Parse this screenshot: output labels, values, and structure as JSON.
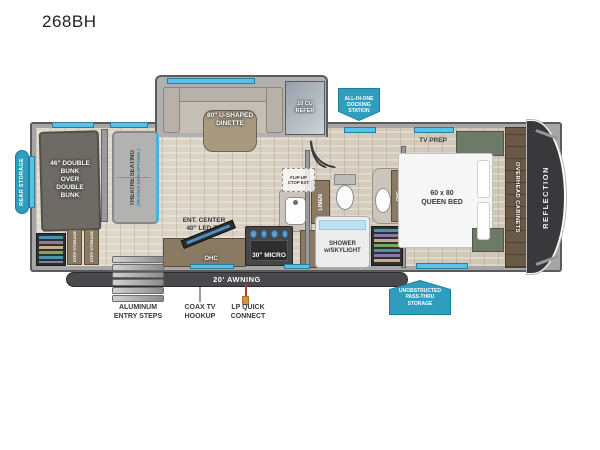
{
  "title": "268BH",
  "colors": {
    "accent_teal": "#2f9dbd",
    "window_teal": "#57c3e6",
    "front_cap": "#39393b"
  },
  "badges": {
    "rear_storage": "REAR STORAGE",
    "docking_station": "ALL-IN-ONE\nDOCKING\nSTATION",
    "pass_thru": "UNOBSTRUCTED\nPASS-THRU\nSTORAGE"
  },
  "slide_out": {
    "dinette": "80\" U-SHAPED\nDINETTE",
    "refrigerator": "10 CU\nREFER"
  },
  "bunk_area": {
    "bunk": "46\" DOUBLE\nBUNK\nOVER\nDOUBLE\nBUNK",
    "step_storage_1": "STEP STORAGE",
    "step_storage_2": "STEP STORAGE"
  },
  "living_area": {
    "theatre_seating": "THEATRE SEATING",
    "theatre_seating_option": "(TRI-FOLD SOFA OPTIONAL)",
    "ent_center": "ENT. CENTER\n40\" LED TV",
    "ent_ohc": "OHC"
  },
  "kitchen": {
    "flip_up_ctop": "FLIP-UP\nCTOP EXT",
    "micro": "30\" MICRO",
    "ohc": "OHC"
  },
  "bathroom": {
    "linen": "LINEN",
    "shower": "SHOWER\nw/SKYLIGHT",
    "vanity_ohc": "OHC"
  },
  "bedroom": {
    "tv_prep": "TV PREP",
    "queen_bed": "60 x 80\nQUEEN BED",
    "overhead_cabinets": "OVERHEAD CABINETS",
    "brand": "REFLECTION"
  },
  "exterior": {
    "awning": "20' AWNING",
    "entry_steps": "ALUMINUM\nENTRY STEPS",
    "coax": "COAX TV\nHOOKUP",
    "lp_connect": "LP QUICK\nCONNECT"
  }
}
